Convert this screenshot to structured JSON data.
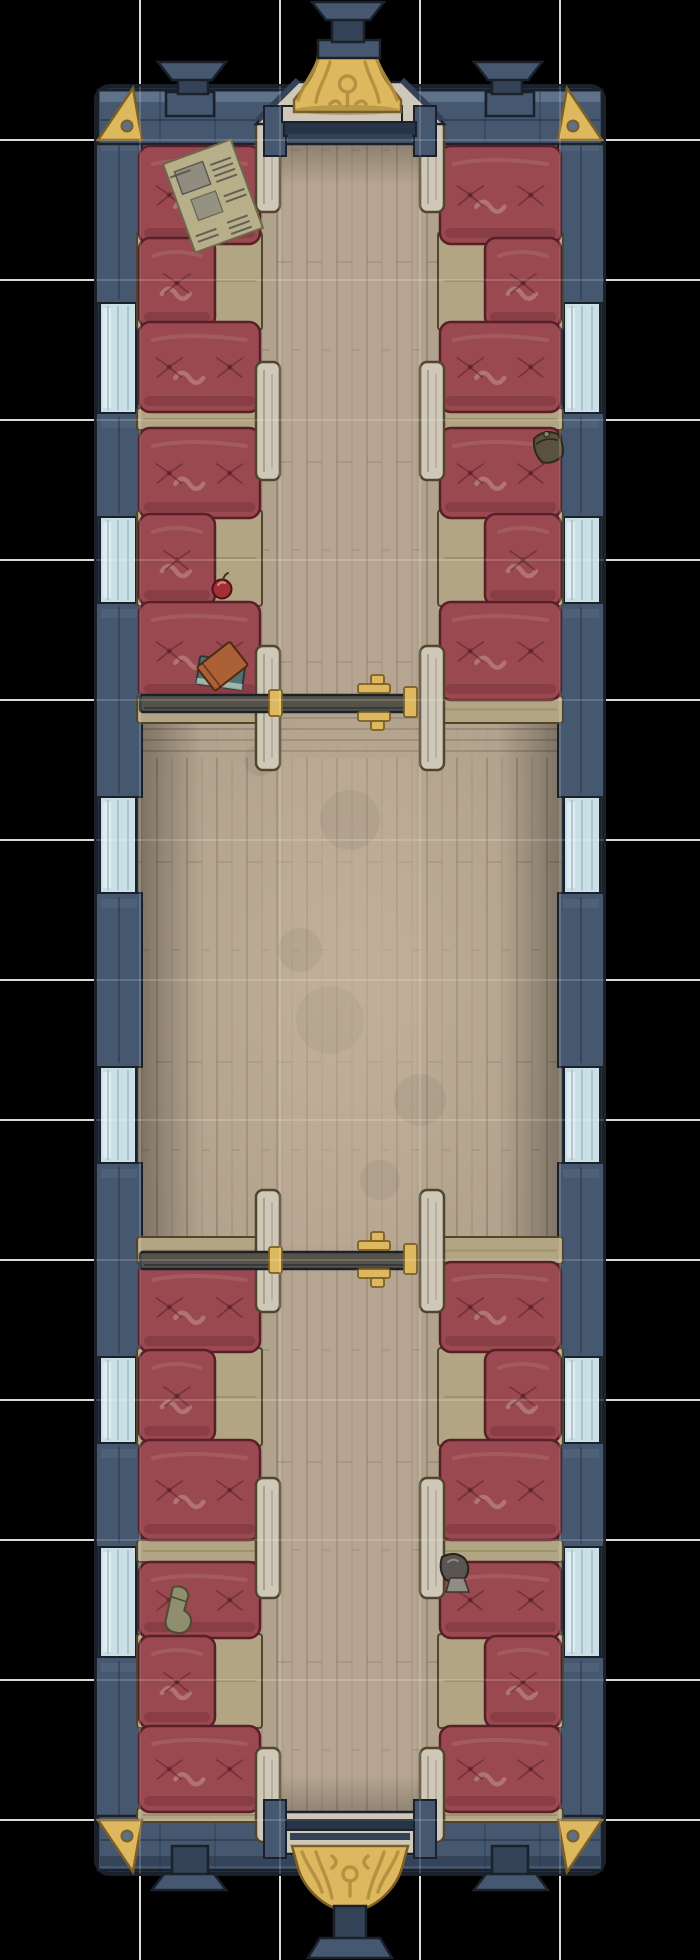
{
  "meta": {
    "title": "Top-down train passenger carriage battle map",
    "style": "hand-painted VTT map"
  },
  "canvas": {
    "width": 700,
    "height": 1960,
    "background": "#000000"
  },
  "grid": {
    "cell_px": 140,
    "columns": 5,
    "rows": 14,
    "line_color": "#ffffff",
    "underlay_opacity": 0.85,
    "overlay_opacity": 0.16,
    "line_width": 2
  },
  "palette": {
    "bg": "#000000",
    "outline": "#1a212b",
    "navy": "#46586f",
    "navy_dark": "#334257",
    "navy_deep": "#273447",
    "navy_light": "#5c7088",
    "navy_hi": "#7d92a8",
    "window_glass": "#c9e0e7",
    "window_hi": "#e6f2f6",
    "window_shade": "#9cb4bd",
    "gold": "#ddb85e",
    "gold_dark": "#b28d3e",
    "gold_deep": "#7c5f25",
    "floor": "#b1a28d",
    "floor_light": "#c8b79e",
    "floor_dark": "#8b7d6c",
    "plank": "#6a5c4c",
    "khaki": "#b2a583",
    "khaki_dark": "#92855e",
    "khaki_line": "#51452c",
    "cushion": "#99494f",
    "cushion_dark": "#7a343c",
    "cushion_deep": "#571f27",
    "cushion_hi": "#b27070",
    "cushion_pale": "#caa097",
    "panel_wood": "#cfc8b8",
    "panel_line": "#8b8373",
    "track_bar": "#55524a",
    "paper": "#b7ae8a",
    "paper_ink": "#55524a",
    "paper_photo": "#8e8c80",
    "book_orange": "#ab6036",
    "book_teal": "#507271",
    "apple_red": "#a23136",
    "bag_dark": "#59523f",
    "boot_gray": "#5a5550",
    "boot_light": "#908c86",
    "sock_olive": "#8f8e6e"
  },
  "car": {
    "bounds": {
      "left": 96,
      "right": 604,
      "top": 86,
      "bottom": 1874
    },
    "window_bands_y": [
      [
        303,
        413
      ],
      [
        517,
        603
      ],
      [
        797,
        893
      ],
      [
        1067,
        1163
      ],
      [
        1357,
        1443
      ],
      [
        1547,
        1657
      ]
    ],
    "pillar_bands_y": [
      [
        136,
        303
      ],
      [
        413,
        517
      ],
      [
        603,
        797
      ],
      [
        893,
        1067
      ],
      [
        1163,
        1357
      ],
      [
        1443,
        1547
      ],
      [
        1657,
        1824
      ]
    ]
  },
  "furniture": {
    "aisle_panels": {
      "left_x": 256,
      "right_x": 420,
      "width": 24,
      "spans_y": [
        [
          120,
          212
        ],
        [
          362,
          480
        ],
        [
          646,
          770
        ],
        [
          1190,
          1312
        ],
        [
          1478,
          1598
        ],
        [
          1748,
          1842
        ]
      ]
    },
    "benches": {
      "upper_left": [
        [
          "footwell",
          137,
          232,
          125,
          98
        ],
        [
          "footwell",
          137,
          510,
          125,
          96
        ],
        [
          "cushion",
          139,
          146,
          121,
          98
        ],
        [
          "cushion",
          139,
          238,
          76,
          90
        ],
        [
          "cushion",
          139,
          322,
          121,
          90
        ],
        [
          "bar",
          137,
          408,
          125,
          22
        ],
        [
          "cushion",
          139,
          428,
          121,
          90
        ],
        [
          "cushion",
          139,
          514,
          76,
          92
        ],
        [
          "cushion",
          139,
          602,
          121,
          98
        ],
        [
          "bar",
          137,
          696,
          125,
          27
        ]
      ],
      "upper_right": [
        [
          "footwell",
          438,
          232,
          125,
          98
        ],
        [
          "footwell",
          438,
          510,
          125,
          96
        ],
        [
          "cushion",
          440,
          146,
          121,
          98
        ],
        [
          "cushion",
          485,
          238,
          76,
          90
        ],
        [
          "cushion",
          440,
          322,
          121,
          90
        ],
        [
          "bar",
          438,
          408,
          125,
          22
        ],
        [
          "cushion",
          440,
          428,
          121,
          90
        ],
        [
          "cushion",
          485,
          514,
          76,
          92
        ],
        [
          "cushion",
          440,
          602,
          121,
          98
        ],
        [
          "bar",
          438,
          696,
          125,
          27
        ]
      ],
      "lower_left": [
        [
          "bar",
          137,
          1237,
          125,
          27
        ],
        [
          "cushion",
          139,
          1262,
          121,
          90
        ],
        [
          "footwell",
          137,
          1348,
          125,
          98
        ],
        [
          "cushion",
          139,
          1350,
          76,
          92
        ],
        [
          "cushion",
          139,
          1440,
          121,
          100
        ],
        [
          "bar",
          137,
          1540,
          125,
          22
        ],
        [
          "cushion",
          139,
          1562,
          121,
          76
        ],
        [
          "footwell",
          137,
          1634,
          125,
          94
        ],
        [
          "cushion",
          139,
          1636,
          76,
          92
        ],
        [
          "cushion",
          139,
          1726,
          121,
          86
        ],
        [
          "bar",
          137,
          1808,
          125,
          14
        ]
      ],
      "lower_right": [
        [
          "bar",
          438,
          1237,
          125,
          27
        ],
        [
          "cushion",
          440,
          1262,
          121,
          90
        ],
        [
          "footwell",
          438,
          1348,
          125,
          98
        ],
        [
          "cushion",
          485,
          1350,
          76,
          92
        ],
        [
          "cushion",
          440,
          1440,
          121,
          100
        ],
        [
          "bar",
          438,
          1540,
          125,
          22
        ],
        [
          "cushion",
          440,
          1562,
          121,
          76
        ],
        [
          "footwell",
          438,
          1634,
          125,
          94
        ],
        [
          "cushion",
          485,
          1636,
          76,
          92
        ],
        [
          "cushion",
          440,
          1726,
          121,
          86
        ],
        [
          "bar",
          438,
          1808,
          125,
          14
        ]
      ]
    },
    "sliding_doors": [
      {
        "track": [
          140,
          695,
          276,
          17
        ],
        "latch_x": 358,
        "latches_y": [
          675,
          712
        ],
        "caps": [
          [
            269,
            690,
            13,
            26
          ],
          [
            404,
            687,
            13,
            30
          ]
        ]
      },
      {
        "track": [
          140,
          1252,
          276,
          17
        ],
        "latch_x": 358,
        "latches_y": [
          1232,
          1269
        ],
        "caps": [
          [
            269,
            1247,
            13,
            26
          ],
          [
            404,
            1244,
            13,
            30
          ]
        ]
      }
    ]
  },
  "props": [
    {
      "name": "newspaper",
      "x": 213,
      "y": 196,
      "rotation": -20
    },
    {
      "name": "apple",
      "x": 222,
      "y": 589,
      "rotation": 0
    },
    {
      "name": "books",
      "x": 221,
      "y": 673,
      "rotation": 0
    },
    {
      "name": "leather-pouch",
      "x": 549,
      "y": 448,
      "rotation": -10
    },
    {
      "name": "kettle",
      "x": 454,
      "y": 1568,
      "rotation": 0
    },
    {
      "name": "sock",
      "x": 180,
      "y": 1612,
      "rotation": 8
    }
  ]
}
